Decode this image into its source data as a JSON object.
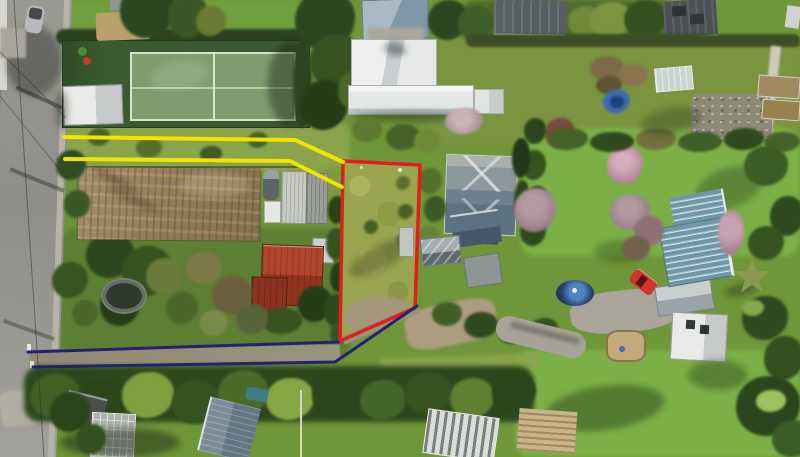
{
  "scene": {
    "type": "aerial-drone-photograph",
    "subject": "suburban residential block with surveyed lot boundaries drawn over the photo",
    "visible_text": "none",
    "lighting": "sunny, shadows falling toward lower-left"
  },
  "boundaries": {
    "red_lot_outline": {
      "label": "subject vacant lot (red outline)",
      "color": "#e11d1d",
      "stroke_width": 3.5,
      "points": "343,161 420,165 415,308 340,341"
    },
    "yellow_accessway_top": {
      "label": "yellow accessway boundary - upper line",
      "color": "#f0e400",
      "stroke_width": 4,
      "points": "64,137 295,140 343,162"
    },
    "yellow_accessway_bottom": {
      "label": "yellow accessway boundary - lower line",
      "color": "#f0e400",
      "stroke_width": 4,
      "points": "65,159 290,161 342,187"
    },
    "navy_driveway_top": {
      "label": "navy driveway boundary - upper line",
      "color": "#232272",
      "stroke_width": 3,
      "points": "28,352 338,342"
    },
    "navy_driveway_bottom": {
      "label": "navy driveway boundary - lower line",
      "color": "#232272",
      "stroke_width": 3,
      "points": "33,367 335,362 417,306"
    }
  },
  "palette": {
    "base_grass": "#6f9639",
    "bright_lawn": "#7cb046",
    "lot_scrub": "#9aa54f",
    "dirt_field": "#97815b",
    "road_asphalt": "#92918c",
    "tree_dark": "#24391b",
    "court_surround": "#3c5a31",
    "court_surface": "#7e9c6d",
    "white_roof": "#eceded",
    "red_roof": "#a8402a",
    "teal_roof": "#6d97a7",
    "slate_roof": "#7b8c99",
    "charcoal_roof": "#4b5154"
  },
  "features": {
    "road": {
      "label": "street along left edge",
      "color": "#92918c"
    },
    "footpath": {
      "label": "light footpath strip beside road",
      "color": "#b7b3a9"
    },
    "parked_car_road": {
      "label": "car parked on road at top left",
      "color": "#b9babd"
    },
    "tennis_court": {
      "label": "tennis court with dark green surround",
      "color": "#7e9c6d"
    },
    "white_shed": {
      "label": "white gabled shed left of tennis court",
      "color": "#eaebe9"
    },
    "tan_deck": {
      "label": "tan deck/structure above tennis court",
      "color": "#b9a06b"
    },
    "dirt_garden": {
      "label": "large tilled dirt garden plot",
      "color": "#97815b"
    },
    "sheds_cluster": {
      "label": "group of small sheds and parked items north of red barn",
      "color": "#c7c9c4"
    },
    "red_barn": {
      "label": "red corrugated-roof barn (L-shaped)",
      "color": "#b2452d"
    },
    "trampoline": {
      "label": "dark round trampoline / play frame",
      "color": "#2f3a2f"
    },
    "bluegray_barn": {
      "label": "blue-grey gabled roof at top centre",
      "color": "#8fa3b2"
    },
    "white_house": {
      "label": "large white-roofed house, top centre",
      "color": "#eceded"
    },
    "charcoal_roof_1": {
      "label": "charcoal ribbed roof top centre-right",
      "color": "#585f62"
    },
    "charcoal_roof_2": {
      "label": "charcoal gabled roof top right",
      "color": "#4b5154"
    },
    "hip_roof_house": {
      "label": "grey hip-roof house right of lot",
      "color": "#8c999c"
    },
    "dark_garage": {
      "label": "dark blue-grey garage below hip house",
      "color": "#4e6374"
    },
    "grey_sheds_right": {
      "label": "small grey sheds right of lot bottom",
      "color": "#9aa2a6"
    },
    "teal_house": {
      "label": "teal corrugated-roof house at right",
      "color": "#6d97a7"
    },
    "grey_garage_right": {
      "label": "light grey gabled garage near red car",
      "color": "#c9cecf"
    },
    "red_car": {
      "label": "red car on driveway",
      "color": "#d2342a"
    },
    "swimming_pool": {
      "label": "round blue pool/spa",
      "color": "#27416e"
    },
    "driveway_concrete": {
      "label": "concrete driveway, right property",
      "color": "#aaa59a"
    },
    "sandpit": {
      "label": "sandpit with timber edge",
      "color": "#c3a87a"
    },
    "rock_garden": {
      "label": "stone/rock garden patch upper right",
      "color": "#8d8a78"
    },
    "greenhouse": {
      "label": "small glasshouse upper right",
      "color": "#ccd4d1"
    },
    "blue_tarp": {
      "label": "blue tarp/boat cover in garden",
      "color": "#3a6bb0"
    },
    "pink_blossom_trees": {
      "label": "pink blossom trees",
      "color": "#c08fa4"
    },
    "cabbage_tree": {
      "label": "cabbage tree / palm lower right",
      "color": "#8a9a52"
    },
    "white_house_br": {
      "label": "white building bottom right",
      "color": "#e9eae8"
    },
    "slate_building": {
      "label": "slate-blue long roof bottom left",
      "color": "#7b8c99"
    },
    "greenhouse_frame": {
      "label": "glasshouse frame bottom left",
      "color": "#aeb4ab"
    },
    "white_frame_structure": {
      "label": "white ribbed structure bottom centre",
      "color": "#d9dcd9"
    },
    "pallet_stack": {
      "label": "timber pallets bottom centre",
      "color": "#c9b489"
    },
    "teal_car": {
      "label": "teal vehicle bottom left",
      "color": "#3e7d86"
    },
    "tree_belt": {
      "label": "dense tree belt below driveway",
      "color": "#2e481d"
    },
    "power_lines": {
      "label": "overhead power lines along road",
      "color": "#2d2d2d"
    }
  }
}
